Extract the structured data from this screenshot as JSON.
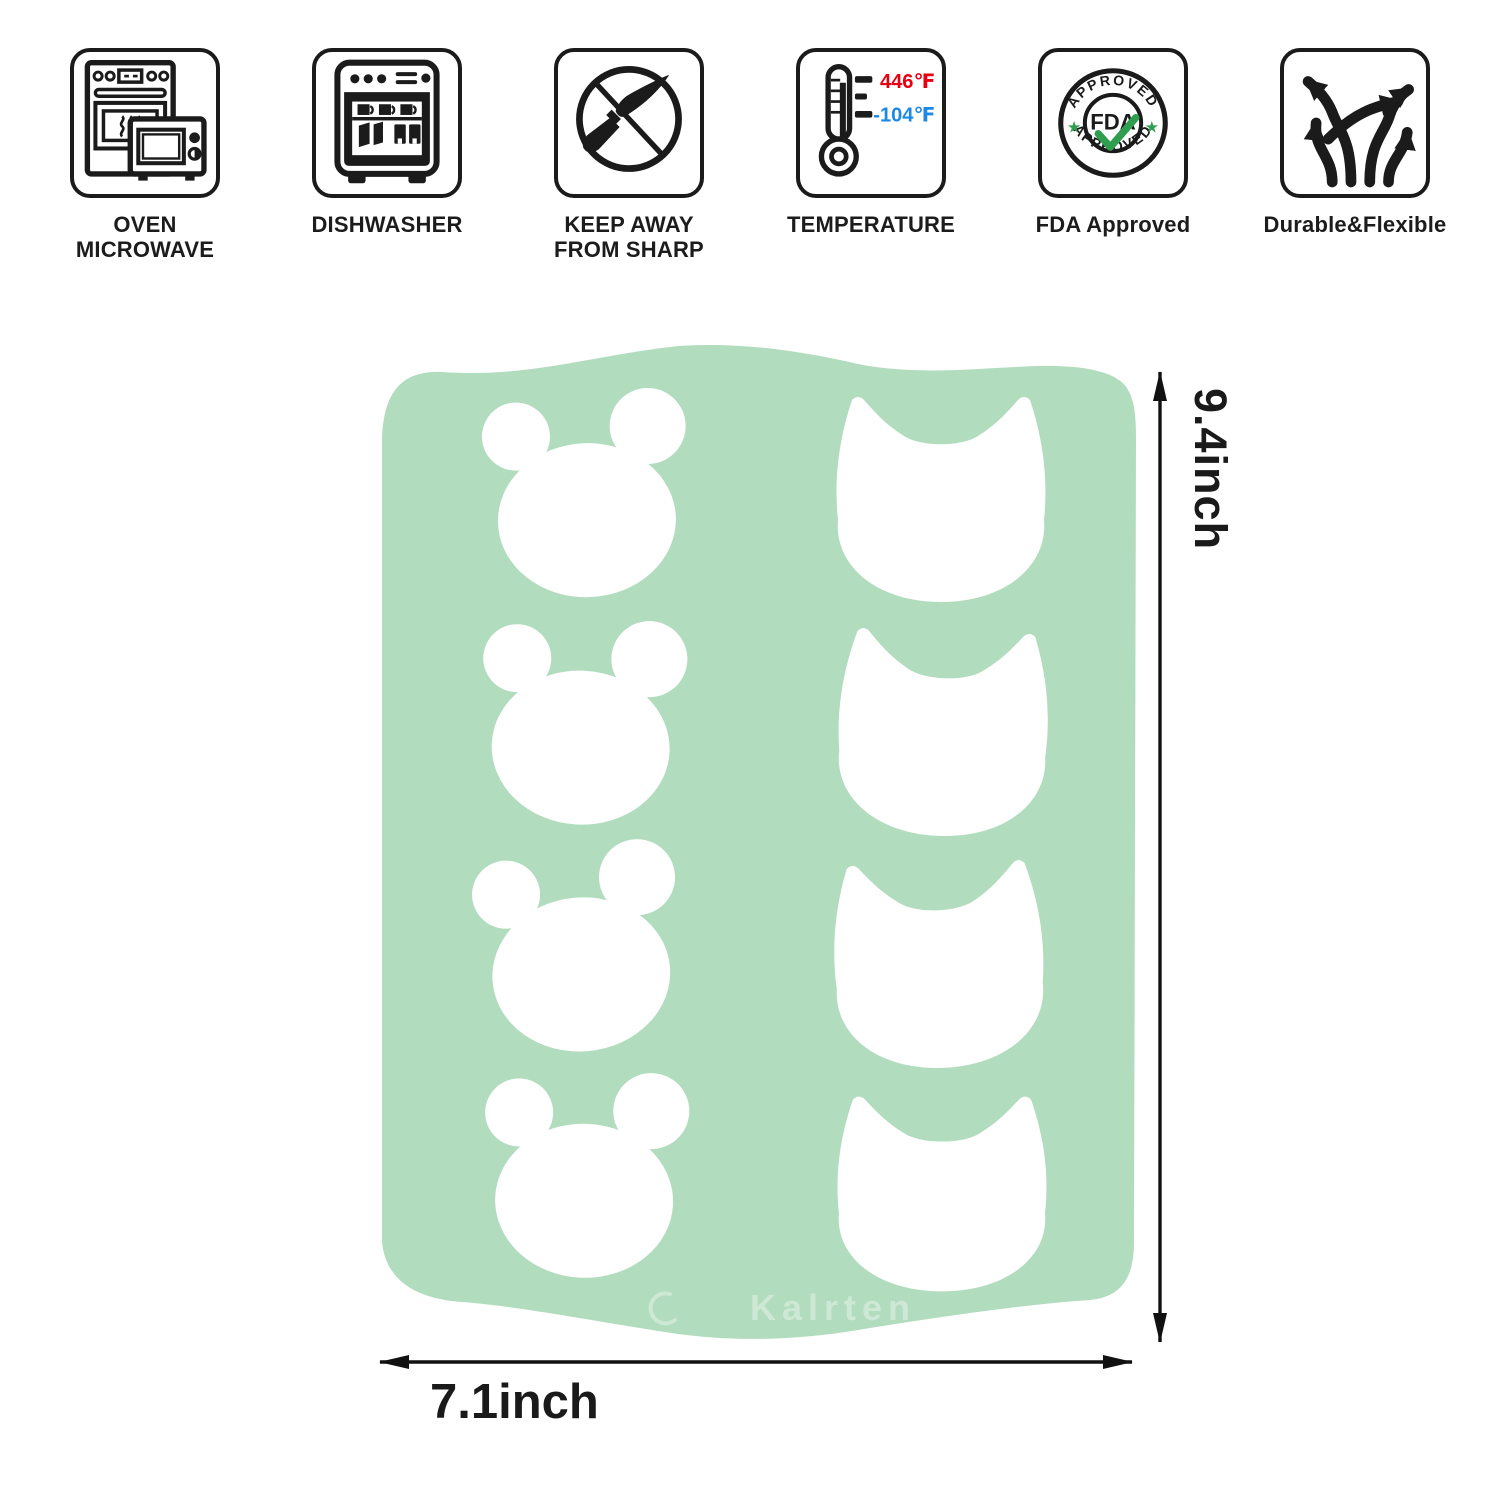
{
  "page": {
    "background": "#ffffff"
  },
  "features": [
    {
      "id": "oven-microwave",
      "label": "OVEN\nMICROWAVE"
    },
    {
      "id": "dishwasher",
      "label": "DISHWASHER"
    },
    {
      "id": "keep-away-sharp",
      "label": "KEEP AWAY\nFROM SHARP"
    },
    {
      "id": "temperature",
      "label": "TEMPERATURE",
      "high": "446℉",
      "low": "-104℉",
      "high_color": "#e60012",
      "low_color": "#1e88e5"
    },
    {
      "id": "fda-approved",
      "label": "FDA Approved",
      "badge_top": "APPROVED",
      "badge_bottom": "APPROVED",
      "badge_center": "FDA",
      "star": "★",
      "accent_color": "#2f9e4f"
    },
    {
      "id": "durable-flexible",
      "label": "Durable&Flexible"
    }
  ],
  "mat": {
    "color": "#b2dcbe",
    "watermark": "Kalrten",
    "cutouts": {
      "left_column_shape": "bear",
      "right_column_shape": "cat",
      "rows": 4,
      "total": 8
    }
  },
  "dimensions": {
    "height": "9.4inch",
    "width": "7.1inch"
  }
}
